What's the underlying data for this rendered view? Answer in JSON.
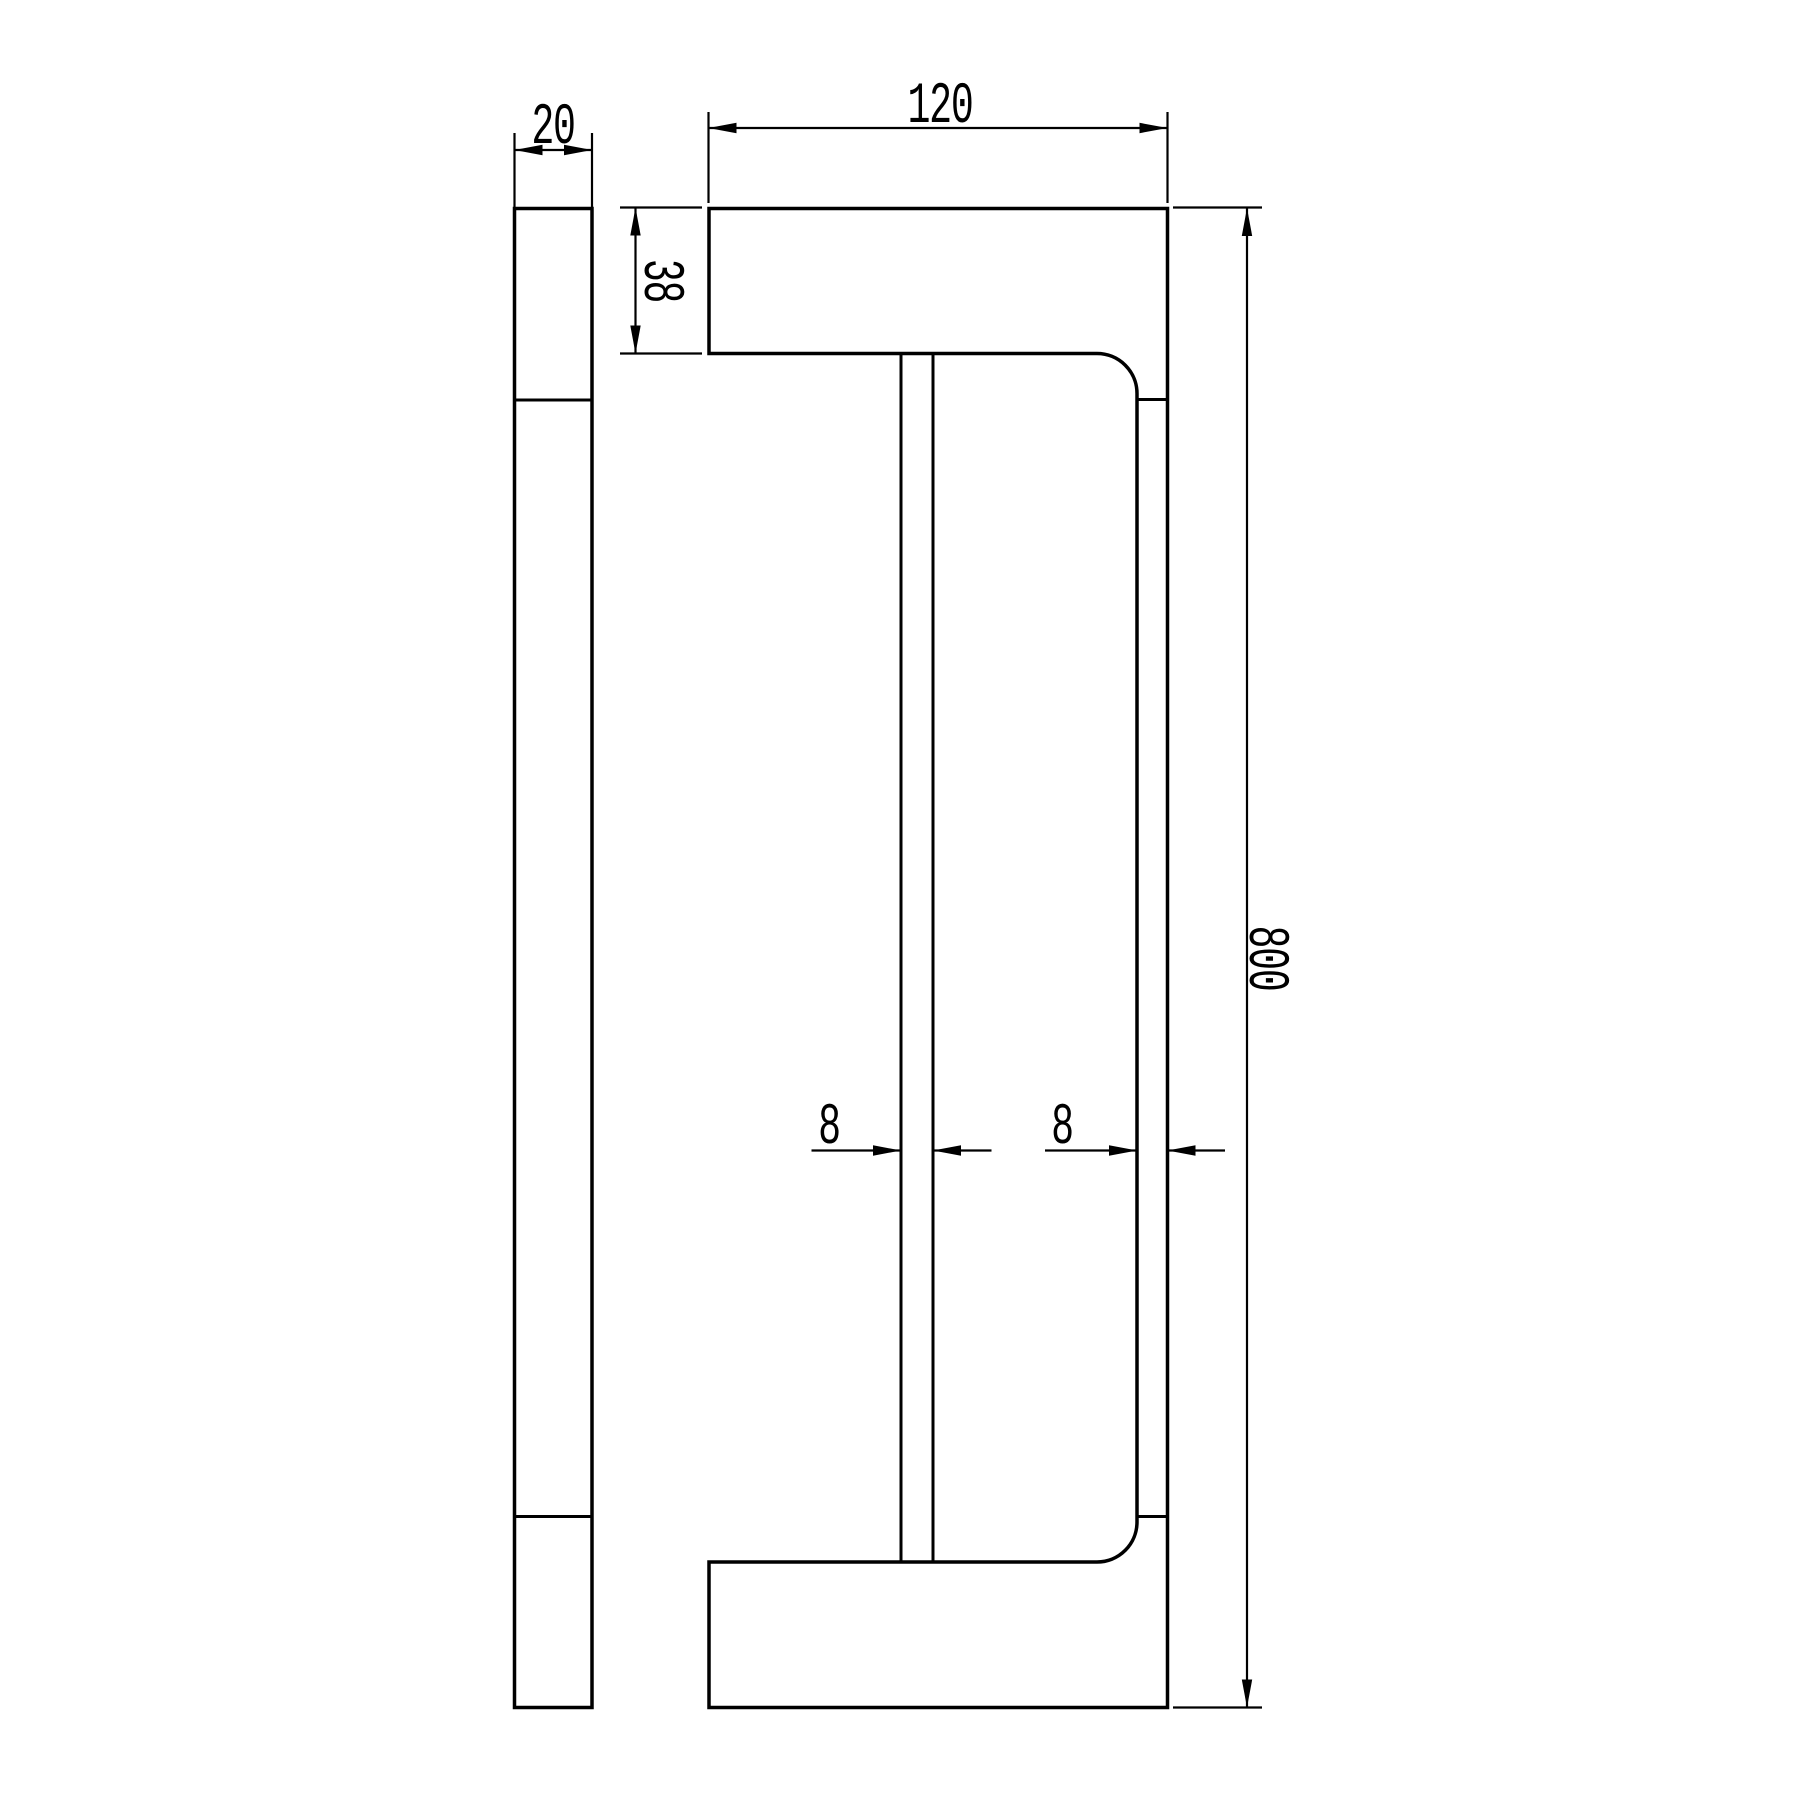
{
  "drawing": {
    "background": "#ffffff",
    "line_color": "#000000",
    "dimensions": {
      "profile_width": {
        "label": "20"
      },
      "flange_length": {
        "label": "120"
      },
      "flange_thickness": {
        "label": "38"
      },
      "overall_height": {
        "label": "800"
      },
      "inner_bar": {
        "label": "8"
      },
      "grip_bar": {
        "label": "8"
      }
    }
  }
}
